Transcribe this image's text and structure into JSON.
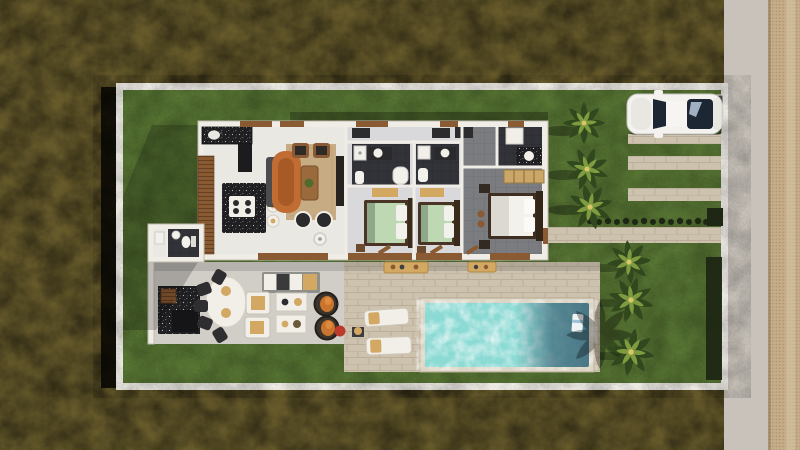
{
  "scene": {
    "title": "Top-down 3D architectural rendering: single-story villa lot with lawn, covered terrace, swimming pool, palm trees, paver driveway with parked car, street and sidewalk",
    "width": 800,
    "height": 450
  },
  "labels": {
    "ground": "Unpaved olive ground surrounding the lot",
    "sidewalk": "Dotted paver sidewalk",
    "road": "Street",
    "lot_wall": "White perimeter wall of the lot",
    "lawn": "Lawn",
    "house": "Villa floor plan",
    "kitchen": "Kitchen with dark counters and island",
    "island": "Kitchen island with cooktop",
    "stools": "Bar stools",
    "living": "Living room with curved orange sofa",
    "tv_console": "TV console",
    "bedroom1": "Bedroom 1 with green bed",
    "bedroom2": "Bedroom 2 with green bed",
    "bath1": "Ensuite bathroom 1",
    "bath2": "Ensuite bathroom 2",
    "master": "Master bedroom with white bed",
    "master_bath": "Master bathroom",
    "closet": "Master closet shelf",
    "powder_room": "Powder room annex",
    "wood_wall": "Slatted wood facade",
    "terrace": "Covered terrace with outdoor furniture",
    "bbq": "Outdoor kitchen / BBQ counter",
    "dining_table": "Outdoor oval dining table",
    "outdoor_sofa": "Outdoor sofa set",
    "egg_chairs": "Rattan egg chairs",
    "pool_deck": "Stone pool deck",
    "pool": "Swimming pool",
    "loungers": "Sun loungers with towels",
    "driveway": "Paver parking strips",
    "walkway": "Entry walkway to street",
    "car": "White car parked on driveway",
    "palms": "Palm trees",
    "hedge": "Low hedge row and planters"
  },
  "colors": {
    "ground": "#665a2b",
    "groundShadow": "#0b0a05",
    "road": "#c8c2ba",
    "sidewalk": "#c4ad88",
    "sidewalkDot": "#a9906a",
    "sidewalkBand": "#d7c6a5",
    "wall": "#f1eee8",
    "lawn": "#587634",
    "stone": "#cdc2ae",
    "stoneLine": "#b6aa94",
    "concrete": "#d1cec8",
    "houseWall": "#f0ede7",
    "houseEdge": "#c2bcb0",
    "floorLight": "#eae8e3",
    "floorMid": "#d9d9db",
    "floorDark": "#7b7c80",
    "tileLine": "#6d6e72",
    "bathFloor": "#323338",
    "bathLine": "#27272b",
    "counter": "#1f1f21",
    "speck": "#d6d7da",
    "wood": "#8a5a32",
    "woodDark": "#5f3d22",
    "rug": "#c7ab82",
    "sofaOrange": "#c06c33",
    "sofaOrangeDark": "#a85a26",
    "chaiseGray": "#4c4c4e",
    "bedGreen": "#bfd8b4",
    "pillow": "#f2f1ec",
    "headboard": "#3a2a1c",
    "benchTan": "#d2a863",
    "closetTan": "#caa768",
    "pool": "#8cdad4",
    "poolDeep": "#3f6b7c",
    "coping": "#dcd5c5",
    "palmDark": "#31471d",
    "palmLight": "#7e9c3f",
    "palmCore": "#d9c66a",
    "hedge": "#1d2714",
    "carBody": "#f3f2ef",
    "carTrim": "#c9c6c0",
    "glass": "#1d2733",
    "glassLight": "#b9c9d9",
    "red": "#bb3a2c",
    "chairDark": "#2e2d2f",
    "white": "#f2efe9",
    "eggFrame": "#3c332a",
    "eggCushion": "#c9752e"
  }
}
